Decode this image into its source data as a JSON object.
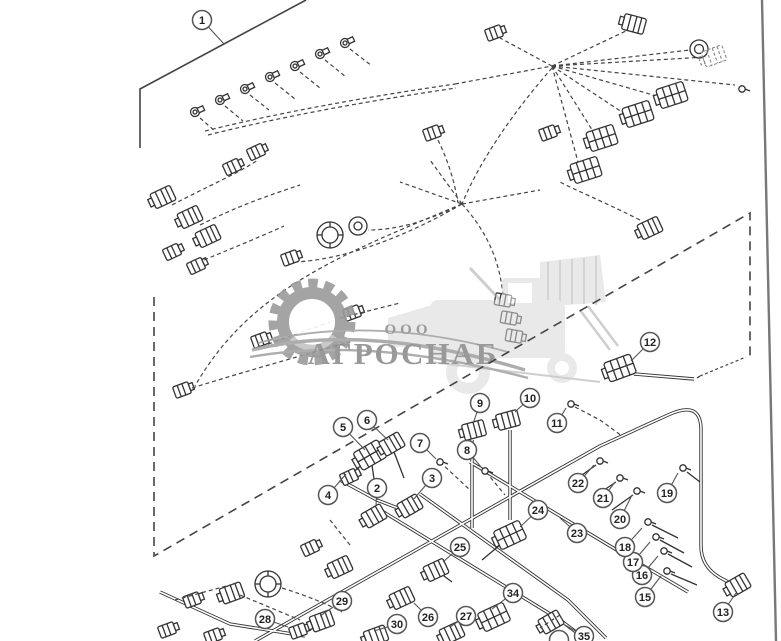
{
  "watermark": {
    "prefix": "ООО",
    "name": "АГРОСНАБ",
    "gray": "#9b9b9b",
    "light_gray": "#d7d7d7"
  },
  "colors": {
    "line_art": "#333333",
    "callout_border": "#555555",
    "background": "#ffffff"
  },
  "callouts": [
    {
      "n": "1",
      "x": 202,
      "y": 20,
      "lx": 224,
      "ly": 44
    },
    {
      "n": "2",
      "x": 377,
      "y": 488,
      "lx": 376,
      "ly": 506
    },
    {
      "n": "3",
      "x": 432,
      "y": 478,
      "lx": 413,
      "ly": 500
    },
    {
      "n": "4",
      "x": 328,
      "y": 495,
      "lx": 346,
      "ly": 474
    },
    {
      "n": "5",
      "x": 343,
      "y": 427,
      "lx": 365,
      "ly": 450
    },
    {
      "n": "6",
      "x": 367,
      "y": 420,
      "lx": 388,
      "ly": 440
    },
    {
      "n": "7",
      "x": 420,
      "y": 443,
      "lx": 436,
      "ly": 459
    },
    {
      "n": "8",
      "x": 467,
      "y": 450,
      "lx": 481,
      "ly": 467
    },
    {
      "n": "9",
      "x": 480,
      "y": 403,
      "lx": 474,
      "ly": 421
    },
    {
      "n": "10",
      "x": 530,
      "y": 398,
      "lx": 515,
      "ly": 412
    },
    {
      "n": "11",
      "x": 557,
      "y": 423,
      "lx": 566,
      "ly": 408
    },
    {
      "n": "12",
      "x": 650,
      "y": 342,
      "lx": 631,
      "ly": 361
    },
    {
      "n": "13",
      "x": 723,
      "y": 612,
      "lx": 736,
      "ly": 593
    },
    {
      "n": "15",
      "x": 645,
      "y": 597,
      "lx": 661,
      "ly": 576
    },
    {
      "n": "16",
      "x": 642,
      "y": 575,
      "lx": 658,
      "ly": 556
    },
    {
      "n": "17",
      "x": 633,
      "y": 562,
      "lx": 650,
      "ly": 542
    },
    {
      "n": "18",
      "x": 625,
      "y": 547,
      "lx": 642,
      "ly": 528
    },
    {
      "n": "19",
      "x": 667,
      "y": 493,
      "lx": 678,
      "ly": 473
    },
    {
      "n": "20",
      "x": 620,
      "y": 519,
      "lx": 632,
      "ly": 495
    },
    {
      "n": "21",
      "x": 603,
      "y": 498,
      "lx": 615,
      "ly": 482
    },
    {
      "n": "22",
      "x": 578,
      "y": 483,
      "lx": 594,
      "ly": 465
    },
    {
      "n": "23",
      "x": 577,
      "y": 533,
      "lx": 560,
      "ly": 518
    },
    {
      "n": "24",
      "x": 538,
      "y": 510,
      "lx": 520,
      "ly": 527
    },
    {
      "n": "25",
      "x": 460,
      "y": 547,
      "lx": 443,
      "ly": 562
    },
    {
      "n": "26",
      "x": 428,
      "y": 617,
      "lx": 414,
      "ly": 603
    },
    {
      "n": "27",
      "x": 466,
      "y": 616,
      "lx": 450,
      "ly": 627
    },
    {
      "n": "28",
      "x": 265,
      "y": 619,
      "lx": 288,
      "ly": 627
    },
    {
      "n": "29",
      "x": 342,
      "y": 601,
      "lx": 320,
      "ly": 616
    },
    {
      "n": "30",
      "x": 397,
      "y": 624,
      "lx": 374,
      "ly": 631
    },
    {
      "n": "34",
      "x": 513,
      "y": 593,
      "lx": 492,
      "ly": 609
    }
  ],
  "partial_callouts": [
    {
      "n": "35",
      "x": 584,
      "y": 636,
      "lx": 565,
      "ly": 625
    },
    {
      "n": "",
      "x": 559,
      "y": 640
    }
  ]
}
